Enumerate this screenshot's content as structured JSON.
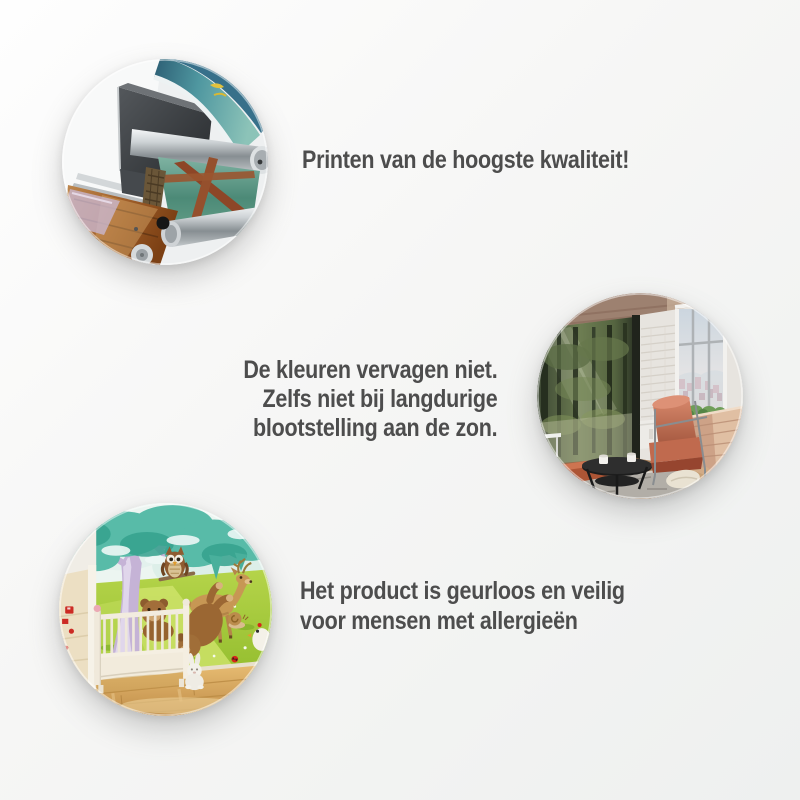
{
  "page": {
    "background_top_left": "#fefefe",
    "background_bottom_right": "#eef0ef",
    "text_color": "#4d4d4d"
  },
  "features": [
    {
      "name": "print-quality",
      "photo": "large-format-printer-printing-landscape-mural",
      "lines": [
        "Printen van de hoogste kwaliteit!"
      ]
    },
    {
      "name": "colors-do-not-fade",
      "photo": "loft-living-room-with-forest-wall-mural",
      "lines": [
        "De kleuren vervagen niet.",
        "Zelfs niet bij langdurige",
        "blootstelling aan de zon."
      ]
    },
    {
      "name": "odorless-allergy-safe",
      "photo": "nursery-with-cartoon-animal-wall-mural-and-crib",
      "lines": [
        "Het product is geurloos en veilig",
        "voor mensen met allergieën"
      ]
    }
  ]
}
